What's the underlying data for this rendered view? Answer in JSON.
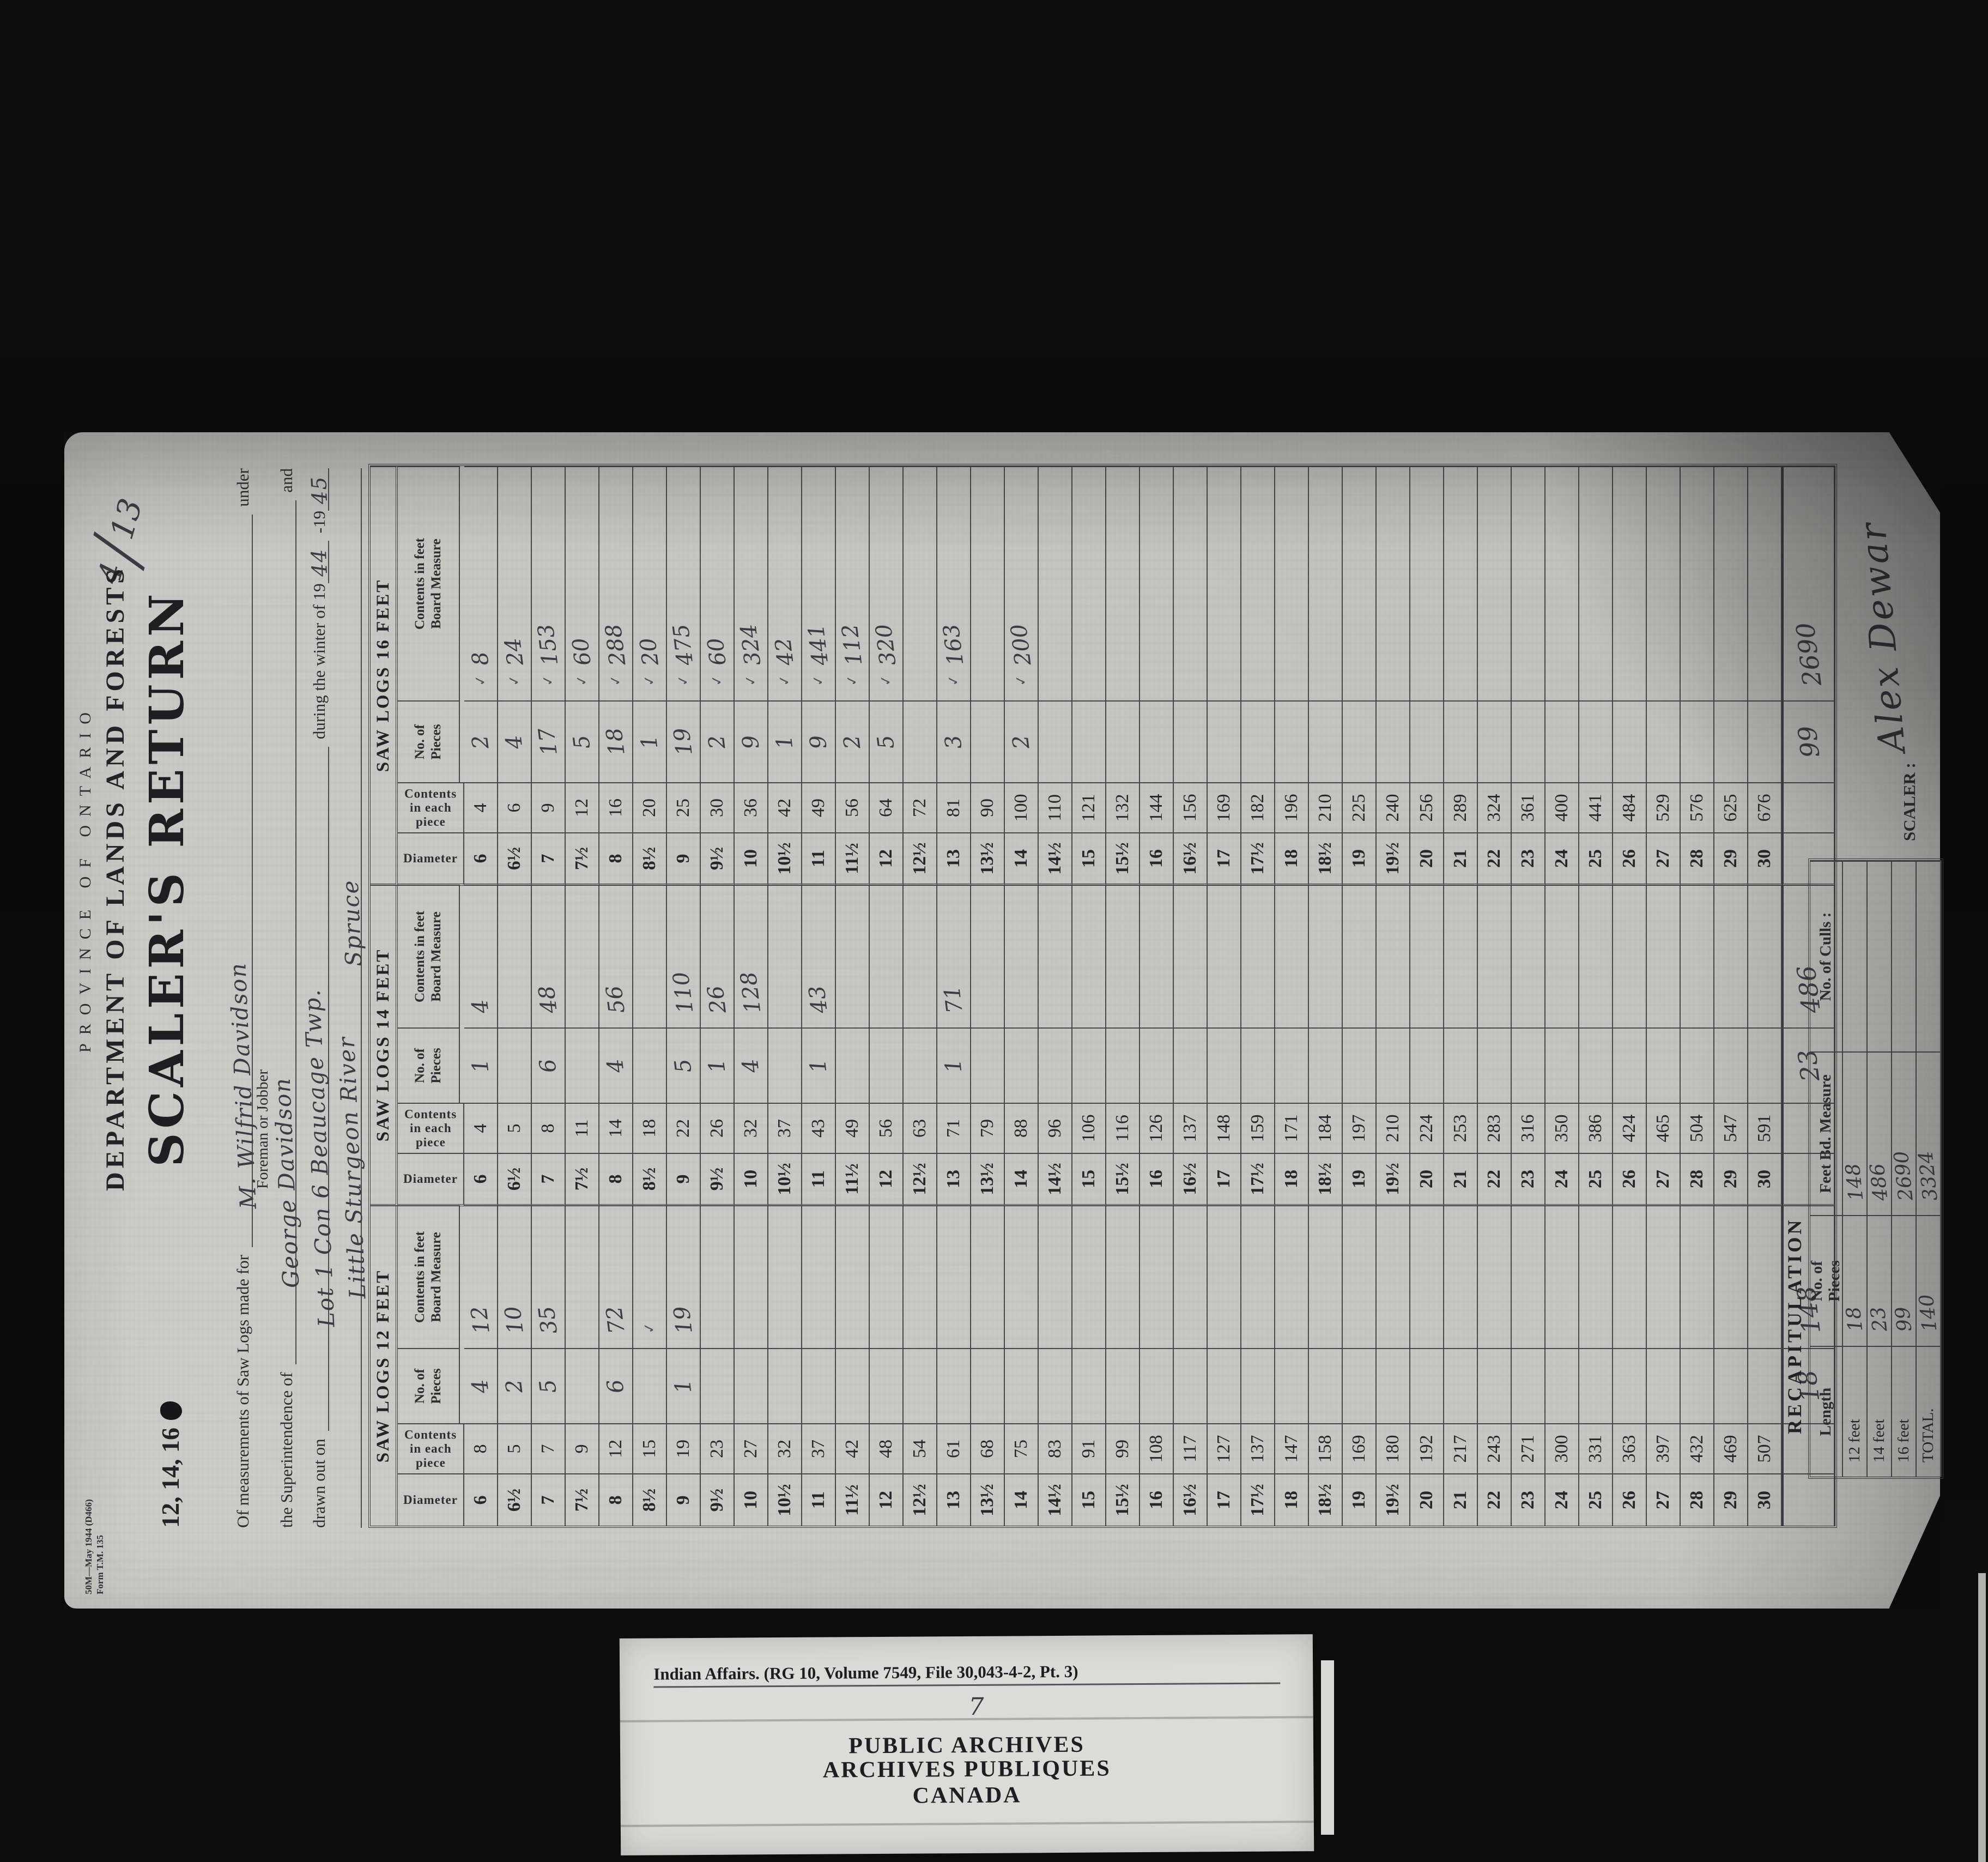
{
  "page": {
    "annotation_top": "4",
    "annotation_bottom": "13",
    "form_number_line1": "50M—May 1944 (D466)",
    "form_number_line2": "Form T.M. 135"
  },
  "header": {
    "province": "PROVINCE OF ONTARIO",
    "department": "DEPARTMENT OF LANDS AND FORESTS",
    "sizes_label": "12, 14, 16",
    "title": "SCALER'S RETURN",
    "line1_label": "Of measurements of Saw Logs made for",
    "line1_value": "M. Wilfrid Davidson",
    "line1_suffix": "under",
    "line1_sublabel": "Foreman or Jobber",
    "line2_label": "the Superintendence of",
    "line2_value": "George Davidson",
    "line2_suffix": "and",
    "line3_label": "drawn out on",
    "line3_value": "Lot 1 Con 6  Beaucage Twp.",
    "line3_mid": "during the winter of 19",
    "year1": "44",
    "line3_sep": "-19",
    "year2": "45",
    "line4_value1": "Little Sturgeon River",
    "line4_value2": "Spruce"
  },
  "table": {
    "col_headers": {
      "diameter": "Diameter",
      "contents": "Contents in each piece",
      "pieces_l1": "No. of",
      "pieces_l2": "Pieces",
      "feet_l1": "Contents in feet",
      "feet_l2": "Board Measure"
    },
    "diameters": [
      "6",
      "6½",
      "7",
      "7½",
      "8",
      "8½",
      "9",
      "9½",
      "10",
      "10½",
      "11",
      "11½",
      "12",
      "12½",
      "13",
      "13½",
      "14",
      "14½",
      "15",
      "15½",
      "16",
      "16½",
      "17",
      "17½",
      "18",
      "18½",
      "19",
      "19½",
      "20",
      "21",
      "22",
      "23",
      "24",
      "25",
      "26",
      "27",
      "28",
      "29",
      "30"
    ],
    "sections": [
      {
        "title": "SAW LOGS 12 FEET",
        "contents": [
          "8",
          "5",
          "7",
          "9",
          "12",
          "15",
          "19",
          "23",
          "27",
          "32",
          "37",
          "42",
          "48",
          "54",
          "61",
          "68",
          "75",
          "83",
          "91",
          "99",
          "108",
          "117",
          "127",
          "137",
          "147",
          "158",
          "169",
          "180",
          "192",
          "217",
          "243",
          "271",
          "300",
          "331",
          "363",
          "397",
          "432",
          "469",
          "507"
        ],
        "pieces": {
          "6": "4",
          "6½": "2",
          "7": "5",
          "8": "6",
          "9": "1"
        },
        "feet": {
          "6": "12",
          "6½": "10",
          "7": "35",
          "8": "72",
          "9": "19"
        },
        "checks": [
          "8½"
        ],
        "total_pieces": "18",
        "total_feet": "148"
      },
      {
        "title": "SAW LOGS 14 FEET",
        "contents": [
          "4",
          "5",
          "8",
          "11",
          "14",
          "18",
          "22",
          "26",
          "32",
          "37",
          "43",
          "49",
          "56",
          "63",
          "71",
          "79",
          "88",
          "96",
          "106",
          "116",
          "126",
          "137",
          "148",
          "159",
          "171",
          "184",
          "197",
          "210",
          "224",
          "253",
          "283",
          "316",
          "350",
          "386",
          "424",
          "465",
          "504",
          "547",
          "591"
        ],
        "pieces": {
          "6": "1",
          "7": "6",
          "8": "4",
          "9": "5",
          "9½": "1",
          "10": "4",
          "11": "1",
          "13": "1"
        },
        "feet": {
          "6": "4",
          "7": "48",
          "8": "56",
          "9": "110",
          "9½": "26",
          "10": "128",
          "11": "43",
          "13": "71"
        },
        "checks": [],
        "total_pieces": "23",
        "total_feet": "486"
      },
      {
        "title": "SAW LOGS 16 FEET",
        "contents": [
          "4",
          "6",
          "9",
          "12",
          "16",
          "20",
          "25",
          "30",
          "36",
          "42",
          "49",
          "56",
          "64",
          "72",
          "81",
          "90",
          "100",
          "110",
          "121",
          "132",
          "144",
          "156",
          "169",
          "182",
          "196",
          "210",
          "225",
          "240",
          "256",
          "289",
          "324",
          "361",
          "400",
          "441",
          "484",
          "529",
          "576",
          "625",
          "676"
        ],
        "pieces": {
          "6": "2",
          "6½": "4",
          "7": "17",
          "7½": "5",
          "8": "18",
          "8½": "1",
          "9": "19",
          "9½": "2",
          "10": "9",
          "10½": "1",
          "11": "9",
          "11½": "2",
          "12": "5",
          "13": "3",
          "14": "2"
        },
        "feet": {
          "6": "8",
          "6½": "24",
          "7": "153",
          "7½": "60",
          "8": "288",
          "8½": "20",
          "9": "475",
          "9½": "60",
          "10": "324",
          "10½": "42",
          "11": "441",
          "11½": "112",
          "12": "320",
          "13": "163",
          "14": "200"
        },
        "checks": [
          "6",
          "6½",
          "7",
          "7½",
          "8",
          "8½",
          "9",
          "9½",
          "10",
          "10½",
          "11",
          "11½",
          "12",
          "13",
          "14"
        ],
        "total_pieces": "99",
        "total_feet": "2690"
      }
    ]
  },
  "recap": {
    "title": "RECAPITULATION",
    "headers": [
      [
        "Length",
        ""
      ],
      [
        "No. of",
        "Pieces"
      ],
      [
        "Feet Bd. Measure",
        ""
      ],
      [
        "No. of Culls :",
        ""
      ]
    ],
    "rows": [
      {
        "length": "12 feet",
        "pieces": "18",
        "feet": "148",
        "culls": ""
      },
      {
        "length": "14 feet",
        "pieces": "23",
        "feet": "486",
        "culls": ""
      },
      {
        "length": "16 feet",
        "pieces": "99",
        "feet": "2690",
        "culls": ""
      },
      {
        "length": "TOTAL.",
        "pieces": "140",
        "feet": "3324",
        "culls": ""
      }
    ],
    "scaler_label": "SCALER :",
    "scaler_signature": "Alex Dewar"
  },
  "archive_label": {
    "line1": "Indian Affairs.  (RG 10, Volume 7549, File 30,043-4-2, Pt. 3)",
    "page_note": "7",
    "line2": "PUBLIC ARCHIVES",
    "line3": "ARCHIVES PUBLIQUES",
    "line4": "CANADA"
  }
}
